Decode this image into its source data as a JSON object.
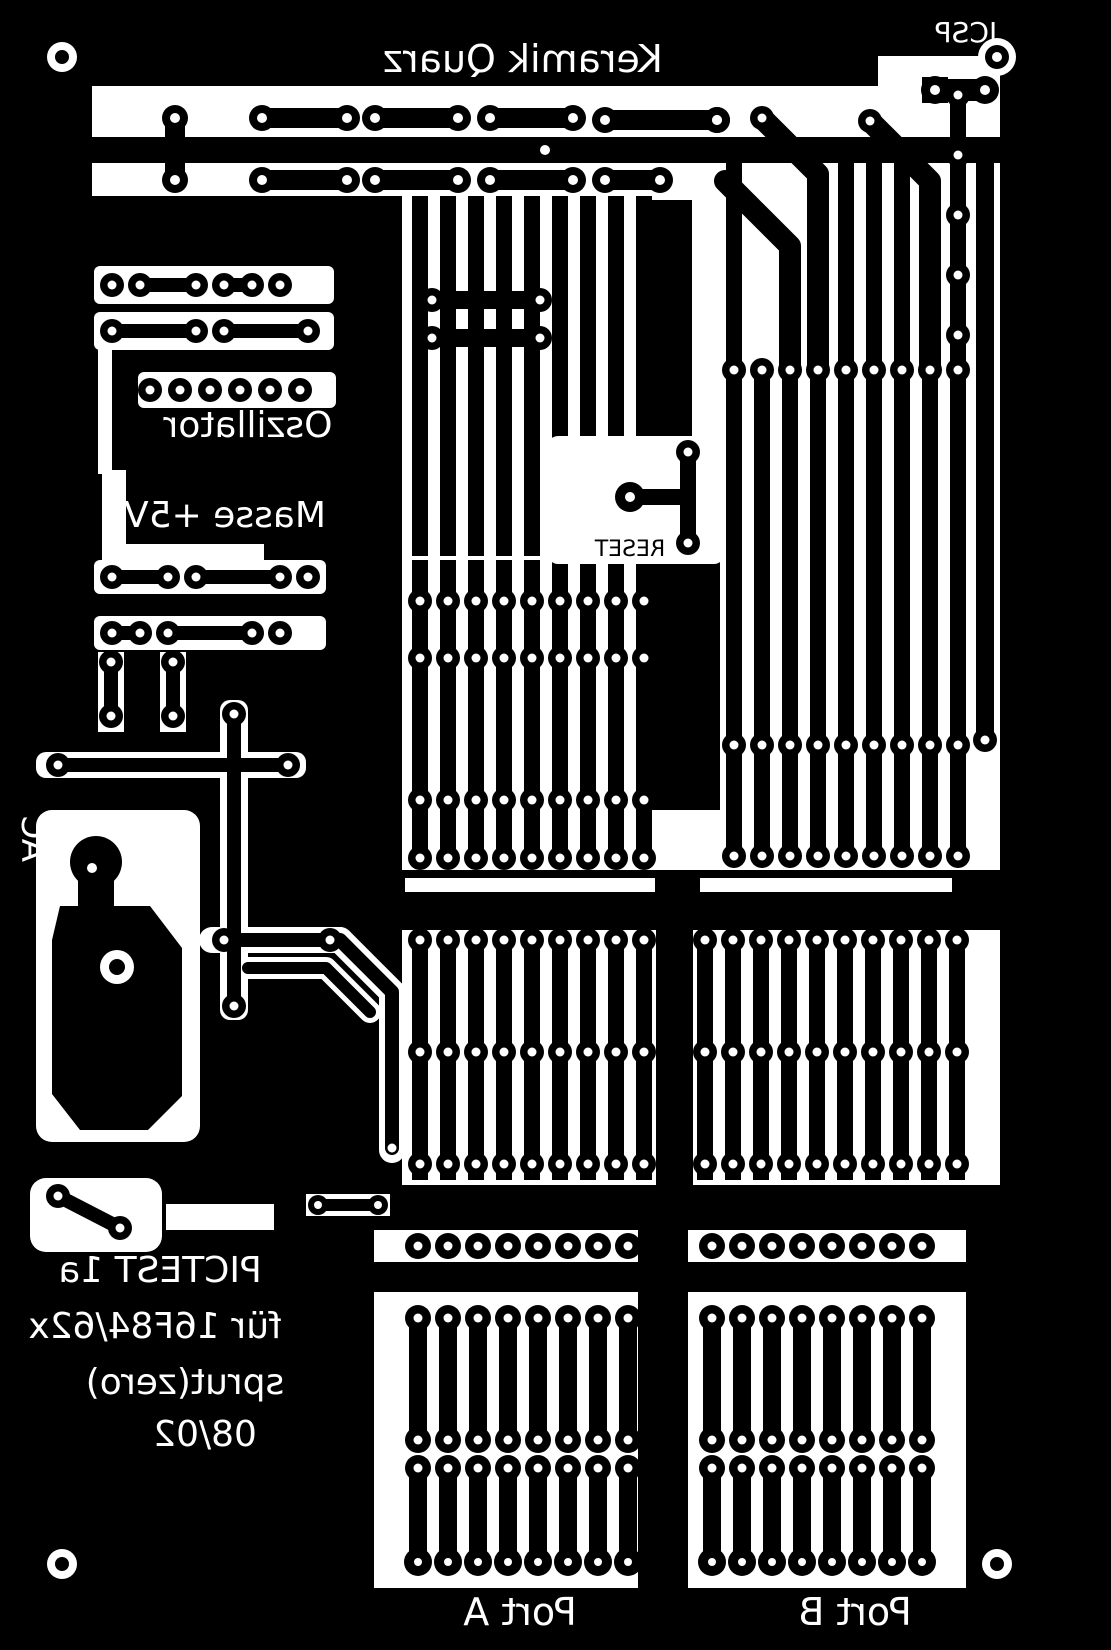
{
  "colors": {
    "copper": "#000000",
    "board_clear": "#ffffff"
  },
  "labels": {
    "keramik_quarz": "Keramik Quarz",
    "icsp": "ICSP",
    "oszillator": "Oszillator",
    "masse_plus_5v": "Masse +5V",
    "reset": "RESET",
    "ac": "AC",
    "project_line1": "PICTEST 1a",
    "project_line2": "für 16F84/62x",
    "project_line3": "sprut(zero)",
    "project_line4": "08/02",
    "port_a": "Port A",
    "port_b": "Port B"
  }
}
